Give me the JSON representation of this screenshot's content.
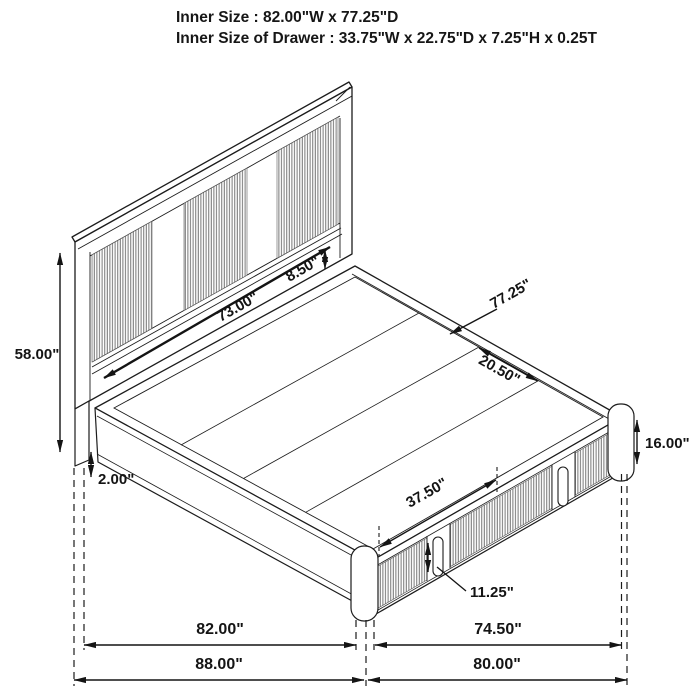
{
  "header": {
    "line1": "Inner Size : 82.00\"W x 77.25\"D",
    "line2": "Inner Size of Drawer : 33.75\"W x 22.75\"D x 7.25\"H x 0.25T"
  },
  "dims": {
    "height": "58.00\"",
    "headboard_width": "73.00\"",
    "headboard_rail": "8.50\"",
    "deck_depth": "77.25\"",
    "deck_panel": "20.50\"",
    "base_height": "16.00\"",
    "floor_clearance": "2.00\"",
    "drawer_span": "37.50\"",
    "drawer_front_height": "11.25\"",
    "side_inner": "82.00\"",
    "foot_inner": "74.50\"",
    "side_overall": "88.00\"",
    "foot_overall": "80.00\""
  },
  "colors": {
    "line": "#1c1c1c",
    "slat_line": "#767676",
    "background": "#ffffff"
  },
  "diagram": {
    "subject": "Isometric dimension drawing of a storage platform bed with slatted headboard and two front drawers"
  }
}
